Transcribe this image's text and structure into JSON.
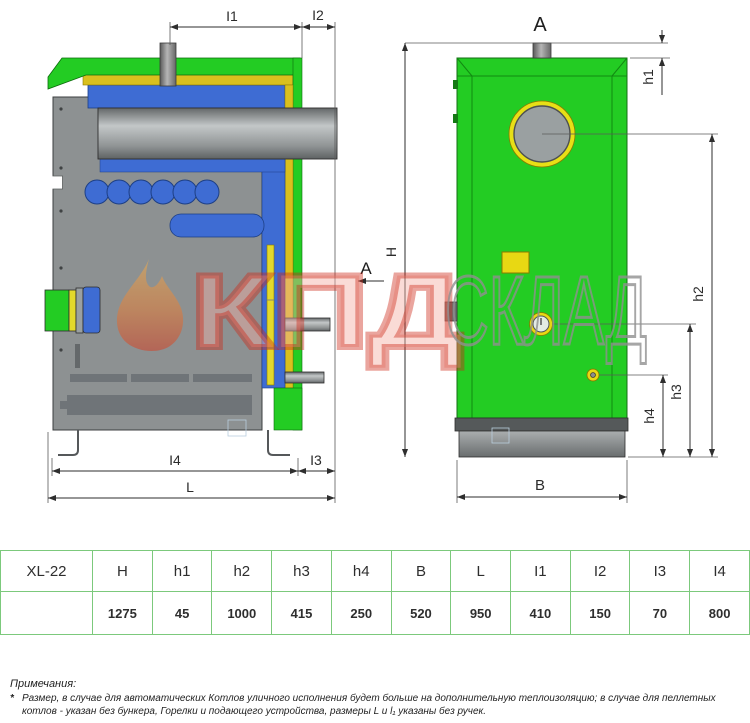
{
  "drawing": {
    "side": {
      "i1": "I1",
      "i2": "I2",
      "i3": "I3",
      "i4": "I4",
      "l": "L",
      "section_a": "A"
    },
    "back": {
      "view_a": "A",
      "h": "H",
      "h1": "h1",
      "h2": "h2",
      "h3": "h3",
      "h4": "h4",
      "b": "B"
    }
  },
  "watermark": {
    "brand": "КПД",
    "shop": "СКЛАД"
  },
  "table": {
    "model": "XL-22",
    "headers": [
      "H",
      "h1",
      "h2",
      "h3",
      "h4",
      "B",
      "L",
      "I1",
      "I2",
      "I3",
      "I4"
    ],
    "values": [
      "1275",
      "45",
      "1000",
      "415",
      "250",
      "520",
      "950",
      "410",
      "150",
      "70",
      "800"
    ]
  },
  "notes": {
    "title": "Примечания:",
    "marker": "*",
    "text": "Размер, в случае для автоматических Котлов уличного исполнения будет больше на дополнительную теплоизоляцию; в случае для пеллетных котлов - указан без бункера, Горелки и подающего устройства, размеры L и l₁ указаны без ручек."
  },
  "colors": {
    "casing_green": "#23cc23",
    "insulation_yellow": "#d9c01e",
    "jacket_blue": "#3e6cd3",
    "body_gray": "#8d9192",
    "table_border": "#7cc97c",
    "watermark_red": "#cd2819",
    "watermark_gray": "#909090"
  }
}
